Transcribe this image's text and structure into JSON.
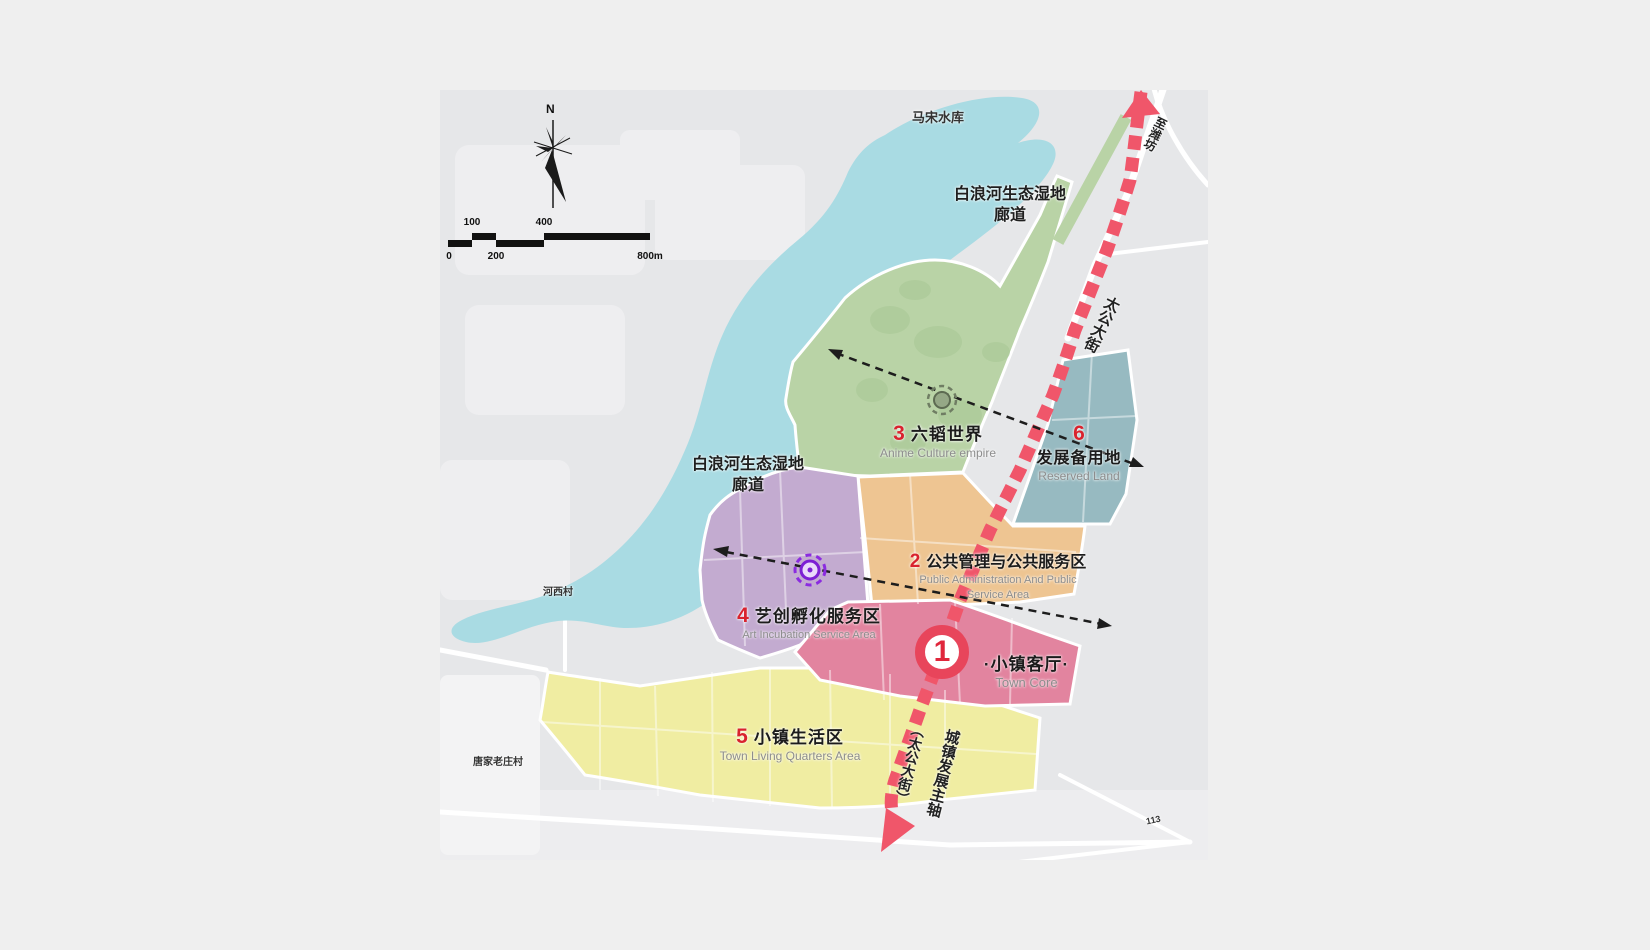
{
  "map": {
    "compass": {
      "north_label": "N"
    },
    "scale_bar": {
      "label_100": "100",
      "label_400": "400",
      "label_0": "0",
      "label_200": "200",
      "label_800": "800m"
    },
    "landmarks": {
      "reservoir": "马宋水库",
      "wetland_top_line1": "白浪河生态湿地",
      "wetland_top_line2": "廊道",
      "wetland_left_line1": "白浪河生态湿地",
      "wetland_left_line2": "廊道",
      "village_west": "河西村",
      "village_south": "唐家老庄村",
      "road_number": "113",
      "to_weifang": "至潍坊",
      "street_top": "太公大街",
      "axis_line1": "城镇发展主轴",
      "axis_line2": "（太公大街）"
    },
    "zones": [
      {
        "number": "1",
        "title": "·小镇客厅·",
        "subtitle": "Town Core",
        "color": "#e2849f"
      },
      {
        "number": "2",
        "title": "公共管理与公共服务区",
        "subtitle": "Public Administration And Public",
        "subtitle2": "Service Area",
        "color": "#eec592"
      },
      {
        "number": "3",
        "title": "六韬世界",
        "subtitle": "Anime Culture empire",
        "color": "#b9d3a6"
      },
      {
        "number": "4",
        "title": "艺创孵化服务区",
        "subtitle": "Art Incubation Service Area",
        "color": "#c3abd0"
      },
      {
        "number": "5",
        "title": "小镇生活区",
        "subtitle": "Town Living Quarters Area",
        "color": "#f0eda2"
      },
      {
        "number": "6",
        "title": "发展备用地",
        "subtitle": "Reserved Land",
        "color": "#97bac1"
      }
    ],
    "colors": {
      "water": "#a9dbe3",
      "axis_red": "#f0566a",
      "number_red": "#d9232e"
    }
  }
}
